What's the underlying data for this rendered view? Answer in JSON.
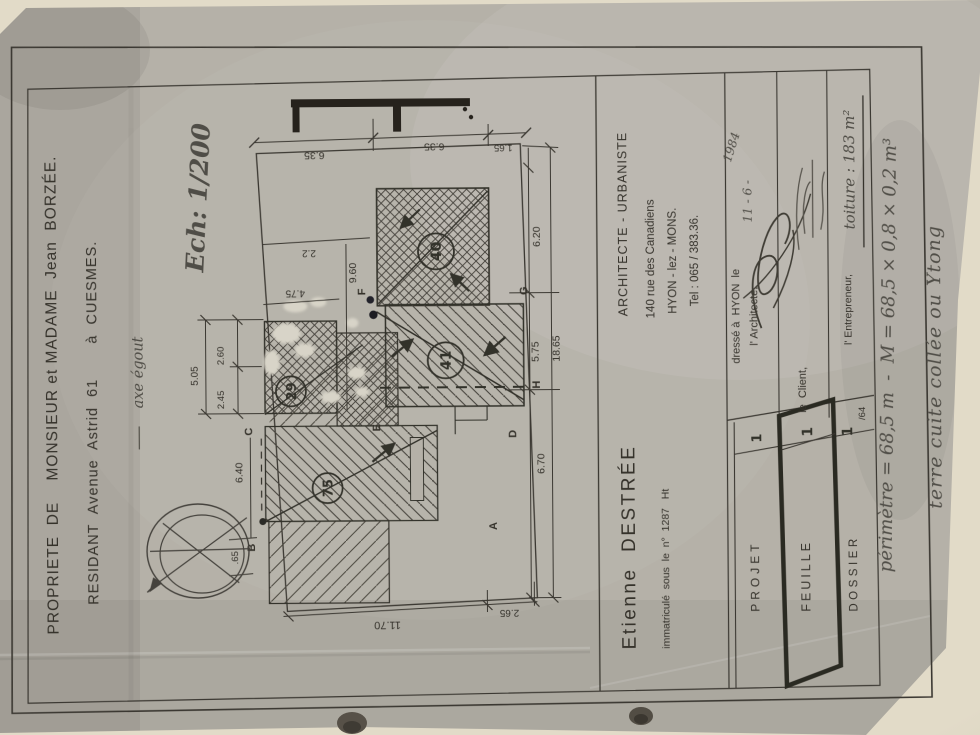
{
  "photo": {
    "paper_color": "#b5b1a8",
    "backing_color": "#e2dbc8",
    "ink_color": "#35322c",
    "pencil_color": "#56534c"
  },
  "owner": {
    "line1": "PROPRIETE  DE    MONSIEUR et MADAME  Jean  BORZÉE.",
    "line2": "RESIDANT  Avenue  Astrid  61       à  CUESMES."
  },
  "plan": {
    "scale_note": "Ech: 1/200",
    "sewer_note": "axe égout",
    "dims": {
      "top1": "6.35",
      "top2": "6.35",
      "top3": "1.65",
      "up_a": "2.2",
      "up_b": "9.60",
      "up_c": "4.75",
      "right_a": "6.20",
      "right_b": "5.75",
      "right_c": "6.70",
      "right_total": "18.65",
      "bottom_a": "11.70",
      "bottom_b": "2.65",
      "left_a": "2.60",
      "left_b": "2.45",
      "left_total": "5.05",
      "west": "6.40",
      "offset": ".65"
    },
    "marks": {
      "a": "40",
      "b": "41",
      "c": "29",
      "d": "75"
    },
    "points": {
      "A": "A",
      "B": "B",
      "C": "C",
      "D": "D",
      "E": "E",
      "F": "F",
      "G": "G",
      "H": "H"
    }
  },
  "architect": {
    "name": "Etienne  DESTRÉE",
    "profession": "ARCHITECTE - URBANISTE",
    "address": "140 rue des Canadiens",
    "city": "HYON - lez - MONS.",
    "phone": "Tel : 065 / 383.36.",
    "registration": "immatriculé  sous  le  n°  1287   Ht"
  },
  "signatures": {
    "drawn_at": "dressé à  HYON  le",
    "date": "11 - 6 -",
    "year": "1984",
    "architect_label": "l' Architecte,",
    "client_label": "le  Client,",
    "contractor_label": "l' Entrepreneur,"
  },
  "cartouche": {
    "projet_label": "PROJET",
    "projet_value": "1",
    "feuille_label": "FEUILLE",
    "feuille_value": "1",
    "dossier_label": "DOSSIER",
    "dossier_value": "1",
    "dossier_index": "/64"
  },
  "handwritten": {
    "roof_area": "toiture : 183 m²",
    "perimeter": "périmètre = 68,5 m  -  M = 68,5 × 0,8 × 0,2 m³",
    "material": "terre cuite collée ou Ytong"
  }
}
